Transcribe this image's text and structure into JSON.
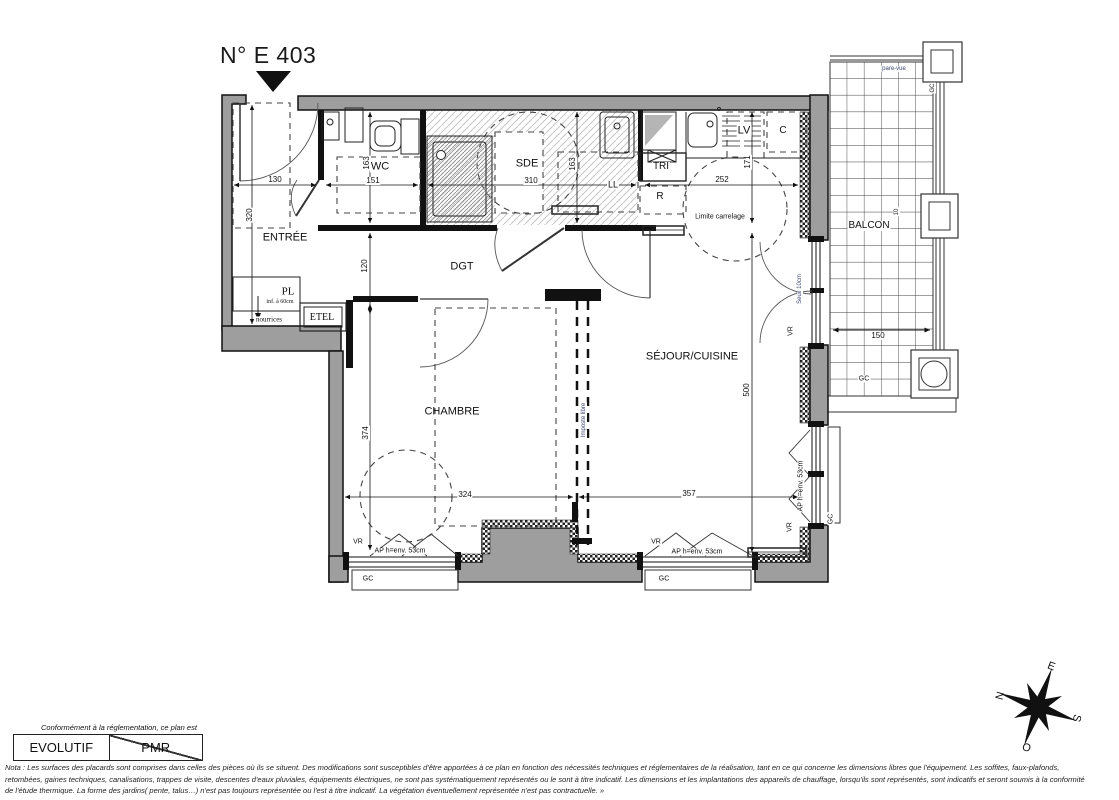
{
  "title": "N° E 403",
  "legend": {
    "caption": "Conformément à la réglementation, ce plan est",
    "evolutif": "EVOLUTIF",
    "pmr": "PMR"
  },
  "nota": {
    "lines": [
      "Nota : Les surfaces des placards sont comprises dans celles des pièces où ils se situent. Des modifications sont susceptibles d'être apportées à ce plan en fonction des nécessités techniques et réglementaires de la réalisation, tant en ce qui concerne les dimensions libres que l'équipement.  Les soffites, faux-plafonds,",
      "retombées, gaines techniques, canalisations, trappes de visite, descentes d'eaux pluviales, équipements électriques, ne sont pas systématiquement représentés ou le sont à titre indicatif. Les dimensions et les implantations des appareils de chauffage, lorsqu'ils sont représentés, sont indicatifs et seront soumis à la conformité",
      "de l'étude thermique. La forme des jardins( pente, talus…) n'est pas toujours représentée ou l'est à titre indicatif. La végétation éventuellement représentée n'est pas contractuelle. »"
    ]
  },
  "plan": {
    "rooms": [
      "ENTRÉE",
      "WC",
      "SDE",
      "DGT",
      "CHAMBRE",
      "SÉJOUR/CUISINE",
      "BALCON",
      "TRI",
      "R",
      "LV",
      "C",
      "LL",
      "PL",
      "ETEL"
    ],
    "labels": [
      {
        "n": "room-entree",
        "t": "ENTRÉE",
        "x": 285,
        "y": 238,
        "s": 11
      },
      {
        "n": "room-wc",
        "t": "WC",
        "x": 380,
        "y": 167,
        "s": 11,
        "bg": 1
      },
      {
        "n": "room-sde",
        "t": "SDE",
        "x": 527,
        "y": 164,
        "s": 11,
        "bg": 1
      },
      {
        "n": "room-dgt",
        "t": "DGT",
        "x": 462,
        "y": 267,
        "s": 11
      },
      {
        "n": "room-chambre",
        "t": "CHAMBRE",
        "x": 452,
        "y": 412,
        "s": 11
      },
      {
        "n": "room-sejour-cuisine",
        "t": "SÉJOUR/CUISINE",
        "x": 692,
        "y": 357,
        "s": 11
      },
      {
        "n": "room-balcon",
        "t": "BALCON",
        "x": 869,
        "y": 226,
        "s": 10,
        "bg": 1
      },
      {
        "n": "room-tri",
        "t": "TRI",
        "x": 661,
        "y": 167,
        "s": 10,
        "bg": 1
      },
      {
        "n": "room-r",
        "t": "R",
        "x": 660,
        "y": 197,
        "s": 10,
        "bg": 1
      },
      {
        "n": "room-lv",
        "t": "LV",
        "x": 744,
        "y": 131,
        "s": 11,
        "bg": 1
      },
      {
        "n": "room-c",
        "t": "C",
        "x": 783,
        "y": 131,
        "s": 10
      },
      {
        "n": "room-ll",
        "t": "LL",
        "x": 613,
        "y": 185,
        "s": 9,
        "bg": 1
      },
      {
        "n": "room-pl",
        "t": "PL",
        "x": 288,
        "y": 292,
        "s": 11,
        "f": "serif"
      },
      {
        "n": "room-etel",
        "t": "ETEL",
        "x": 322,
        "y": 318,
        "s": 10,
        "f": "serif",
        "bg": 1
      },
      {
        "n": "annot-pl-inf",
        "t": "inf. à 60cm",
        "x": 280,
        "y": 302,
        "s": 6,
        "f": "serif"
      },
      {
        "n": "annot-nourrices",
        "t": "nourrices",
        "x": 269,
        "y": 320,
        "s": 7,
        "f": "serif",
        "bg": 1
      },
      {
        "n": "annot-limite-carrelage",
        "t": "Limite carrelage",
        "x": 720,
        "y": 217,
        "s": 7,
        "bg": 1
      },
      {
        "n": "annot-seuil",
        "t": "Seuil 10cm",
        "x": 800,
        "y": 289,
        "s": 6,
        "r": -90,
        "c": "#3d4570",
        "bg": 1
      },
      {
        "n": "annot-imposte-libre",
        "t": "Imposte libre",
        "x": 584,
        "y": 420,
        "s": 6,
        "r": -90,
        "c": "#3d4570",
        "bg": 1
      },
      {
        "n": "annot-pare-vue",
        "t": "pare-vue",
        "x": 894,
        "y": 69,
        "s": 6,
        "c": "#3d4570",
        "bg": 1
      },
      {
        "n": "annot-gc-balcon-top",
        "t": "GC",
        "x": 933,
        "y": 88,
        "s": 6,
        "r": -90,
        "bg": 1
      },
      {
        "n": "annot-gc-balcon",
        "t": "GC",
        "x": 864,
        "y": 379,
        "s": 7,
        "bg": 1
      },
      {
        "n": "annot-vr-balcony-door",
        "t": "VR",
        "x": 791,
        "y": 331,
        "s": 7,
        "r": -90,
        "bg": 1
      },
      {
        "n": "annot-vr-right-window",
        "t": "VR",
        "x": 790,
        "y": 527,
        "s": 7,
        "r": -90,
        "bg": 1
      },
      {
        "n": "annot-ap-right-window",
        "t": "AP h=env. 53cm",
        "x": 801,
        "y": 486,
        "s": 7,
        "r": -90,
        "bg": 1
      },
      {
        "n": "annot-gc-right-window",
        "t": "GC",
        "x": 831,
        "y": 519,
        "s": 7,
        "r": -90,
        "bg": 1
      },
      {
        "n": "annot-vr-chambre",
        "t": "VR",
        "x": 358,
        "y": 542,
        "s": 7,
        "bg": 1
      },
      {
        "n": "annot-ap-chambre",
        "t": "AP h=env. 53cm",
        "x": 400,
        "y": 551,
        "s": 7,
        "bg": 1
      },
      {
        "n": "annot-gc-chambre",
        "t": "GC",
        "x": 368,
        "y": 579,
        "s": 7,
        "bg": 1
      },
      {
        "n": "annot-vr-sejour",
        "t": "VR",
        "x": 656,
        "y": 542,
        "s": 7,
        "bg": 1
      },
      {
        "n": "annot-ap-sejour",
        "t": "AP h=env. 53cm",
        "x": 697,
        "y": 552,
        "s": 7,
        "bg": 1
      },
      {
        "n": "annot-gc-sejour",
        "t": "GC",
        "x": 664,
        "y": 579,
        "s": 7,
        "bg": 1
      },
      {
        "n": "dim-130",
        "t": "130",
        "x": 275,
        "y": 180,
        "s": 8,
        "bg": 1
      },
      {
        "n": "dim-320",
        "t": "320",
        "x": 250,
        "y": 215,
        "s": 8,
        "r": -90,
        "bg": 1
      },
      {
        "n": "dim-163-wc",
        "t": "163",
        "x": 367,
        "y": 163,
        "s": 8,
        "r": -90,
        "bg": 1
      },
      {
        "n": "dim-151",
        "t": "151",
        "x": 373,
        "y": 181,
        "s": 8,
        "bg": 1
      },
      {
        "n": "dim-310",
        "t": "310",
        "x": 531,
        "y": 181,
        "s": 8,
        "bg": 1
      },
      {
        "n": "dim-163-sde",
        "t": "163",
        "x": 573,
        "y": 164,
        "s": 8,
        "r": -90,
        "bg": 1
      },
      {
        "n": "dim-252",
        "t": "252",
        "x": 722,
        "y": 180,
        "s": 8,
        "bg": 1
      },
      {
        "n": "dim-171",
        "t": "171",
        "x": 748,
        "y": 162,
        "s": 8,
        "r": -90,
        "bg": 1
      },
      {
        "n": "dim-120",
        "t": "120",
        "x": 365,
        "y": 266,
        "s": 8,
        "r": -90,
        "bg": 1
      },
      {
        "n": "dim-374",
        "t": "374",
        "x": 366,
        "y": 433,
        "s": 8,
        "r": -90,
        "bg": 1
      },
      {
        "n": "dim-324",
        "t": "324",
        "x": 465,
        "y": 495,
        "s": 8,
        "bg": 1
      },
      {
        "n": "dim-357",
        "t": "357",
        "x": 689,
        "y": 494,
        "s": 8,
        "bg": 1
      },
      {
        "n": "dim-500",
        "t": "500",
        "x": 747,
        "y": 390,
        "s": 8,
        "r": -90,
        "bg": 1
      },
      {
        "n": "dim-150",
        "t": "150",
        "x": 878,
        "y": 336,
        "s": 8,
        "bg": 1
      },
      {
        "n": "dim-10",
        "t": "10",
        "x": 897,
        "y": 212,
        "s": 6,
        "r": -90,
        "bg": 1
      },
      {
        "n": "compass-n",
        "t": "N",
        "x": 1001,
        "y": 696,
        "s": 11,
        "r": -75
      },
      {
        "n": "compass-e",
        "t": "E",
        "x": 1051,
        "y": 667,
        "s": 11,
        "r": 20
      },
      {
        "n": "compass-s",
        "t": "S",
        "x": 1076,
        "y": 718,
        "s": 11,
        "r": 105
      },
      {
        "n": "compass-o",
        "t": "O",
        "x": 1027,
        "y": 746,
        "s": 11,
        "r": 195
      }
    ]
  }
}
